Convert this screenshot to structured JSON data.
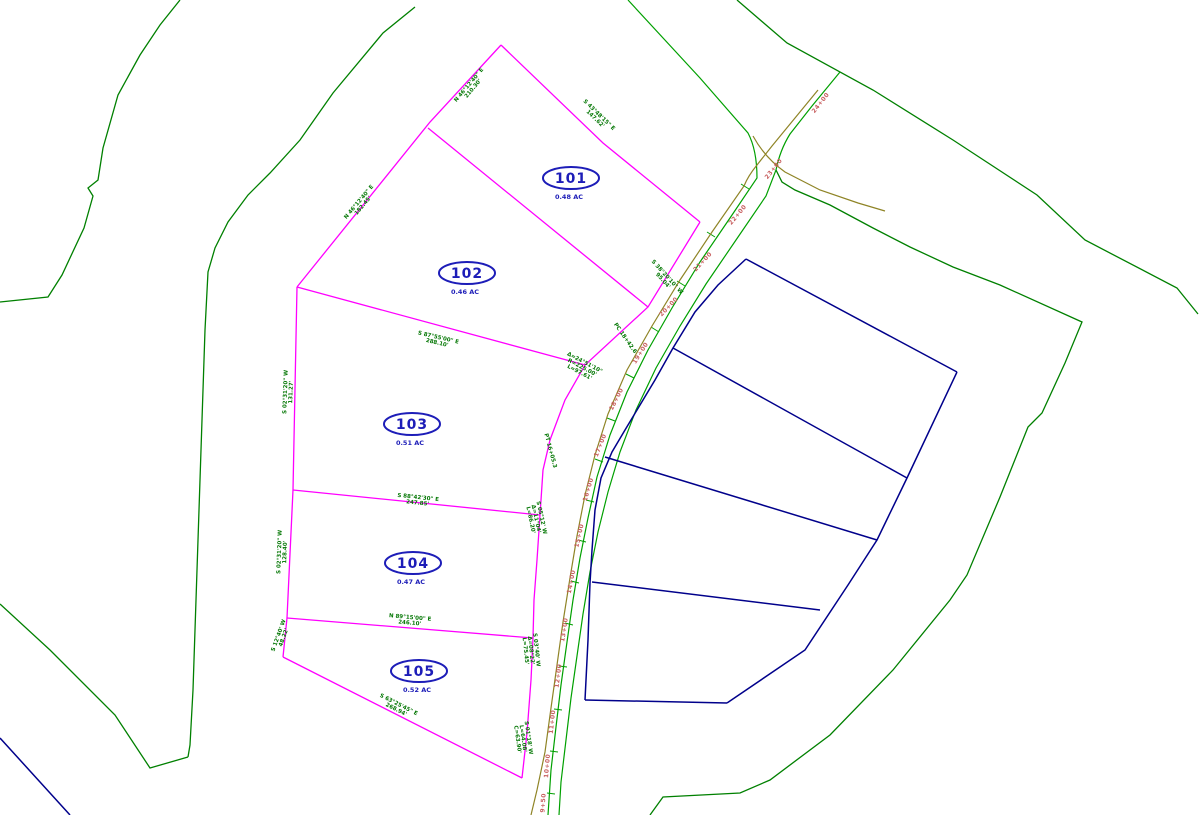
{
  "drawing": {
    "type": "subdivision-plat",
    "background": "#ffffff",
    "colors": {
      "parcel_boundary_green": "#008000",
      "road_edge_green": "#00A000",
      "lot_line_magenta": "#FF00FF",
      "adjacent_lot_navy": "#00008B",
      "easement_olive": "#8F8426",
      "station_text_red": "#C86060",
      "lot_label_blue": "#1D1DB8"
    }
  },
  "lots": [
    {
      "number": "101",
      "area": "0.48 AC",
      "cx": 571,
      "cy": 178
    },
    {
      "number": "102",
      "area": "0.46 AC",
      "cx": 467,
      "cy": 273
    },
    {
      "number": "103",
      "area": "0.51 AC",
      "cx": 412,
      "cy": 424
    },
    {
      "number": "104",
      "area": "0.47 AC",
      "cx": 413,
      "cy": 563
    },
    {
      "number": "105",
      "area": "0.52 AC",
      "cx": 419,
      "cy": 671
    }
  ],
  "bearing_labels": [
    {
      "x": 470,
      "y": 86,
      "rot": -50,
      "lines": [
        "N 46°12'40\" E",
        "210.30'"
      ]
    },
    {
      "x": 598,
      "y": 116,
      "rot": 44,
      "lines": [
        "S 43°48'15\" E",
        "147.62'"
      ]
    },
    {
      "x": 360,
      "y": 203,
      "rot": -50,
      "lines": [
        "N 46°12'40\" E",
        "182.45'"
      ]
    },
    {
      "x": 666,
      "y": 278,
      "rot": 48,
      "lines": [
        "S 38°20'10\" W",
        "95.04'"
      ]
    },
    {
      "x": 584,
      "y": 364,
      "rot": 28,
      "lines": [
        "Δ=24°51'10\"",
        "R=225.00'",
        "L=97.61'"
      ]
    },
    {
      "x": 287,
      "y": 392,
      "rot": -88,
      "lines": [
        "S 02°31'20\" W",
        "131.27'"
      ]
    },
    {
      "x": 438,
      "y": 339,
      "rot": 13,
      "lines": [
        "S 87°55'00\" E",
        "288.10'"
      ]
    },
    {
      "x": 418,
      "y": 499,
      "rot": 6,
      "lines": [
        "S 88°42'30\" E",
        "247.85'"
      ]
    },
    {
      "x": 540,
      "y": 518,
      "rot": 78,
      "lines": [
        "S 05°12' W",
        "Δ=11°04'",
        "L=86.20'"
      ]
    },
    {
      "x": 281,
      "y": 552,
      "rot": -88,
      "lines": [
        "S 02°31'20\" W",
        "128.40'"
      ]
    },
    {
      "x": 410,
      "y": 619,
      "rot": 5,
      "lines": [
        "N 89°15'00\" E",
        "246.10'"
      ]
    },
    {
      "x": 535,
      "y": 650,
      "rot": 84,
      "lines": [
        "S 03°40' W",
        "Δ=08°22'",
        "L=75.45'"
      ]
    },
    {
      "x": 280,
      "y": 636,
      "rot": -70,
      "lines": [
        "S 12°40' W",
        "48.22'"
      ]
    },
    {
      "x": 398,
      "y": 706,
      "rot": 27,
      "lines": [
        "S 63°25'45\" E",
        "268.94'"
      ]
    },
    {
      "x": 527,
      "y": 738,
      "rot": 82,
      "lines": [
        "S 01°18' W",
        "L=64.08'",
        "C=63.90'"
      ]
    },
    {
      "x": 624,
      "y": 339,
      "rot": 55,
      "lines": [
        "PC 18+42.6"
      ]
    },
    {
      "x": 549,
      "y": 451,
      "rot": 75,
      "lines": [
        "PT 16+05.3"
      ]
    }
  ],
  "station_labels": [
    {
      "x": 822,
      "y": 104,
      "rot": -52,
      "text": "24+00"
    },
    {
      "x": 775,
      "y": 170,
      "rot": -52,
      "text": "23+00"
    },
    {
      "x": 739,
      "y": 216,
      "rot": -50,
      "text": "22+00"
    },
    {
      "x": 704,
      "y": 263,
      "rot": -47,
      "text": "21+00"
    },
    {
      "x": 670,
      "y": 308,
      "rot": -46,
      "text": "20+00"
    },
    {
      "x": 642,
      "y": 354,
      "rot": -58,
      "text": "19+00"
    },
    {
      "x": 618,
      "y": 400,
      "rot": -63,
      "text": "18+00"
    },
    {
      "x": 602,
      "y": 446,
      "rot": -68,
      "text": "17+00"
    },
    {
      "x": 590,
      "y": 490,
      "rot": -73,
      "text": "16+00"
    },
    {
      "x": 581,
      "y": 536,
      "rot": -77,
      "text": "15+00"
    },
    {
      "x": 573,
      "y": 582,
      "rot": -79,
      "text": "14+00"
    },
    {
      "x": 566,
      "y": 630,
      "rot": -81,
      "text": "13+00"
    },
    {
      "x": 560,
      "y": 676,
      "rot": -83,
      "text": "12+00"
    },
    {
      "x": 554,
      "y": 722,
      "rot": -84,
      "text": "11+00"
    },
    {
      "x": 549,
      "y": 766,
      "rot": -85,
      "text": "10+00"
    },
    {
      "x": 545,
      "y": 803,
      "rot": -86,
      "text": "9+50"
    }
  ]
}
